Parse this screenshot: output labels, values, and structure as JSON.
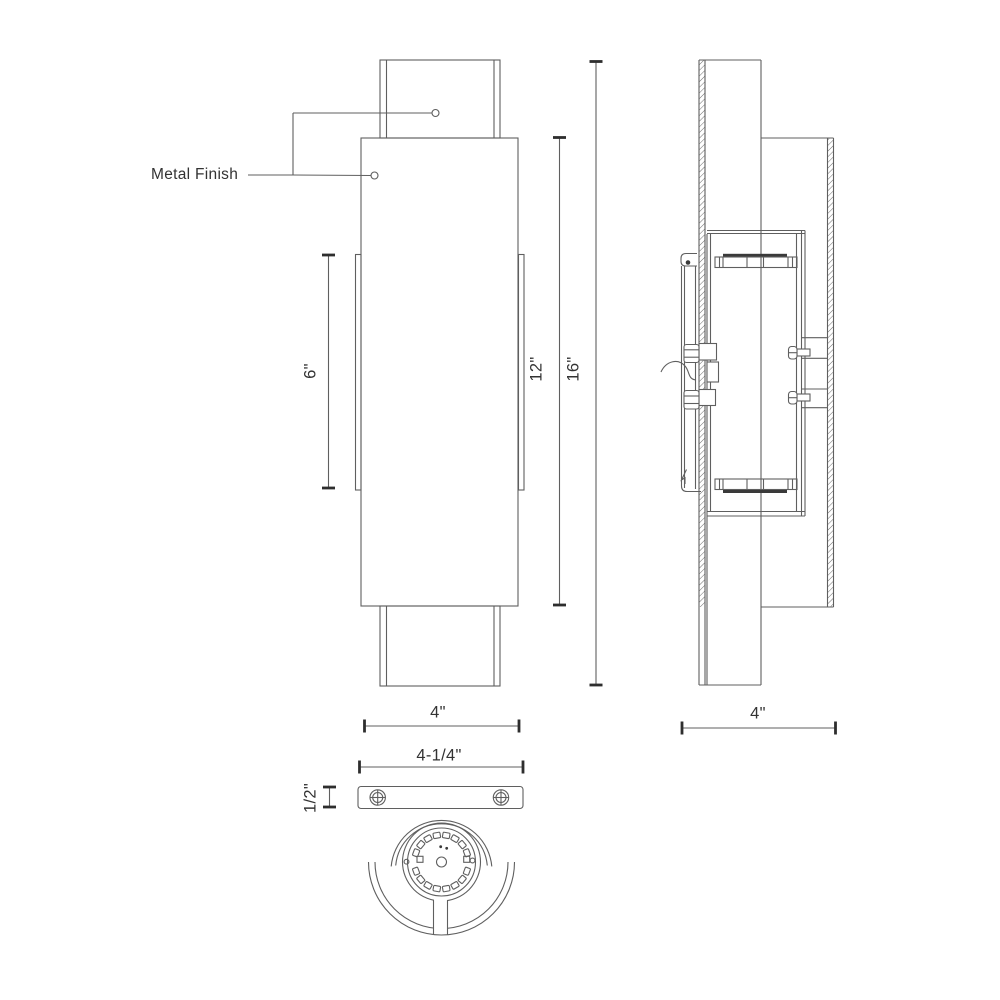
{
  "drawing": {
    "callout": {
      "label": "Metal Finish"
    },
    "front_view": {
      "dim_inner_height": "6\"",
      "dim_body_height": "12\"",
      "dim_overall_height": "16\"",
      "dim_width": "4\""
    },
    "side_view": {
      "dim_depth": "4\""
    },
    "bottom_view": {
      "dim_plate_width": "4-1/4\"",
      "dim_plate_thickness": "1/2\""
    },
    "colors": {
      "line": "#5f5f5f",
      "text": "#333333",
      "background": "#ffffff"
    }
  }
}
